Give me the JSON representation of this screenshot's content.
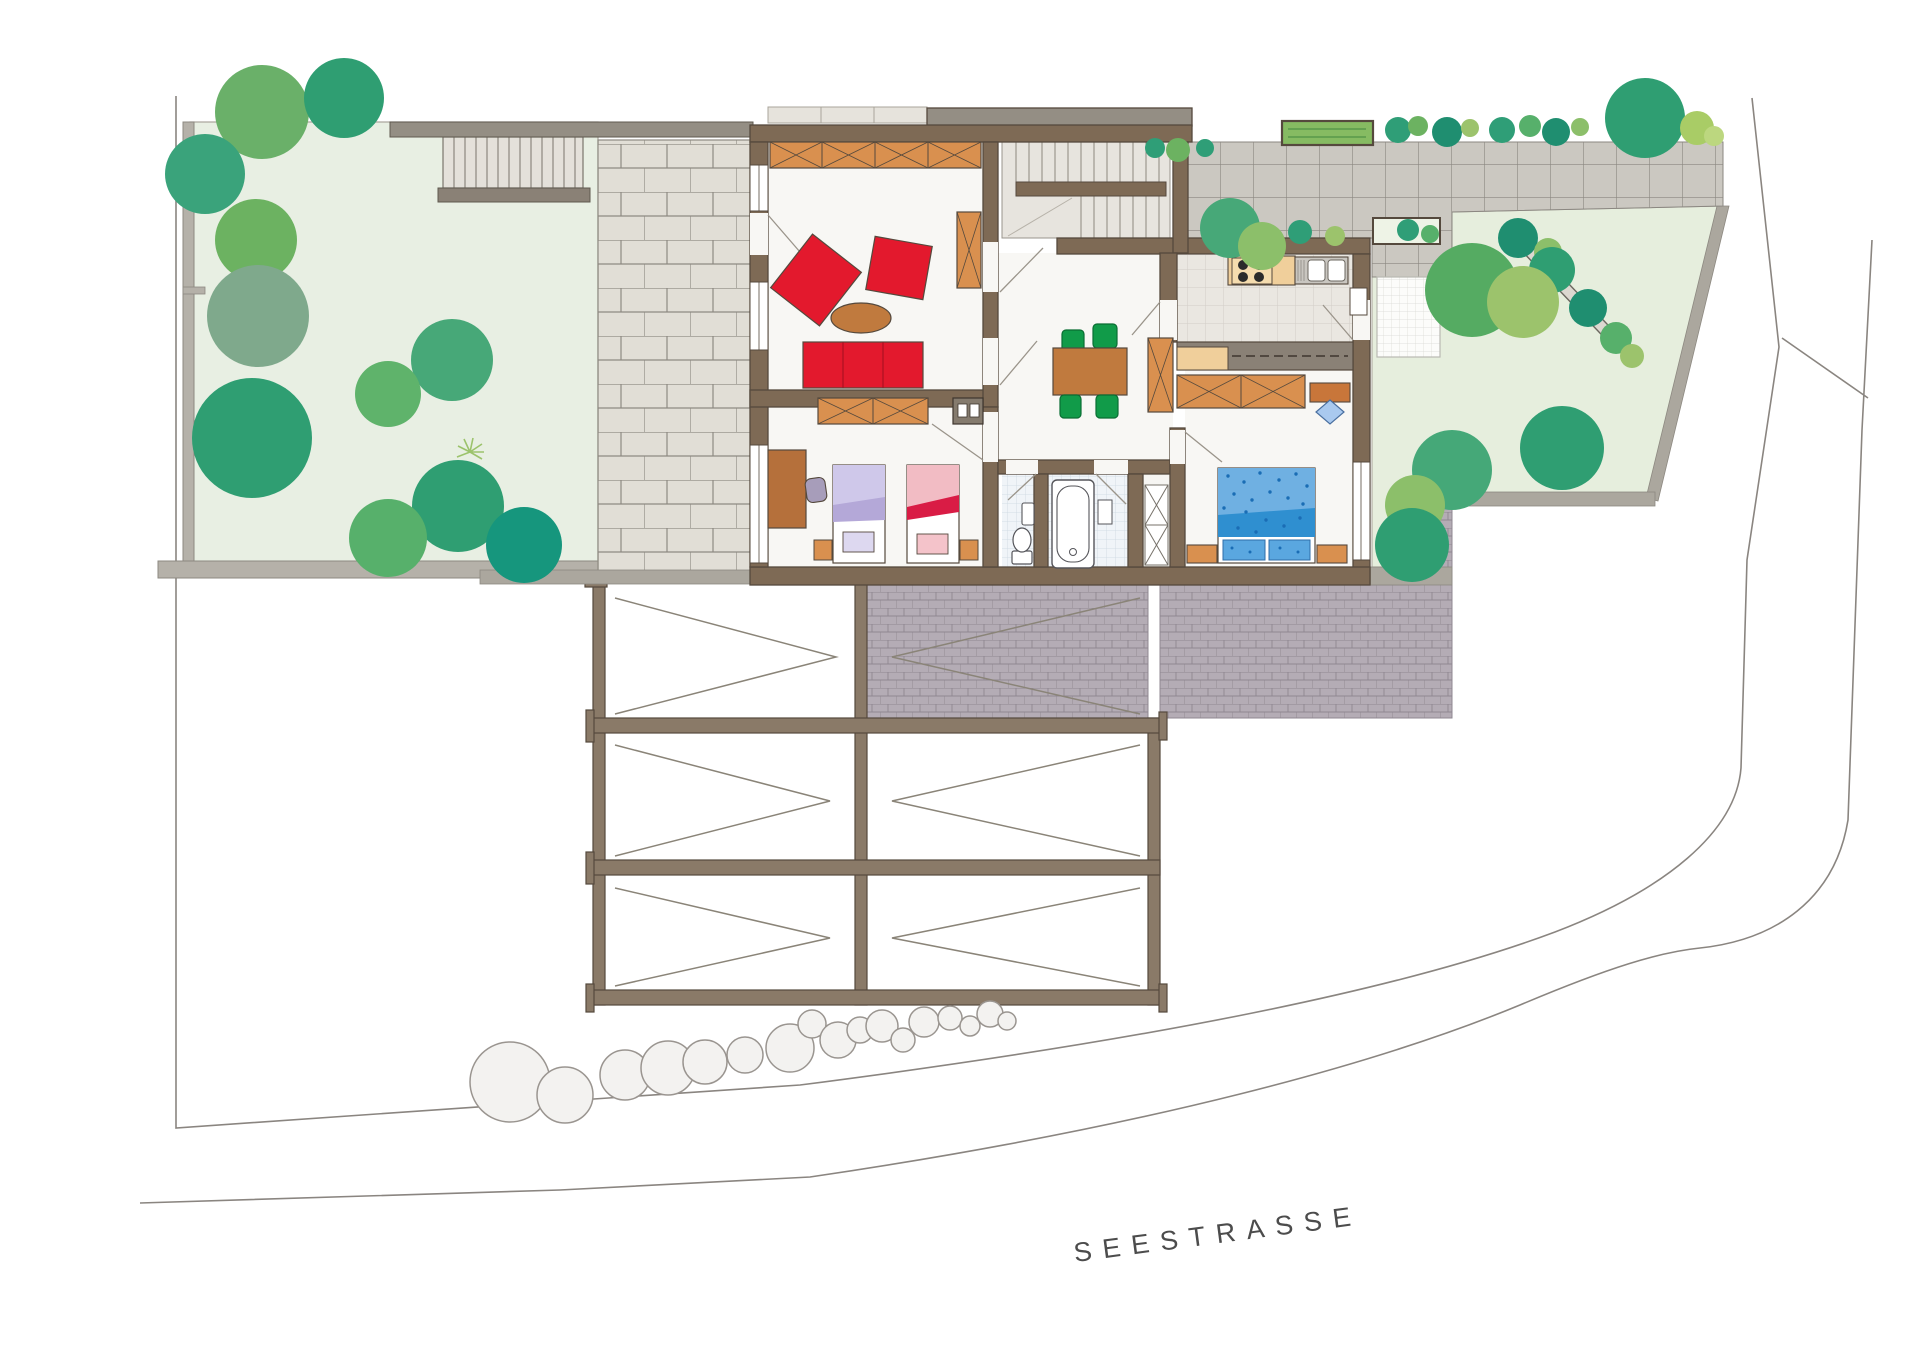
{
  "plan": {
    "street_label": "SEESTRASSE",
    "palette": {
      "lawn": "#e8efe3",
      "lawn_edge": "#a9a49b",
      "wall_brown": "#7e6a55",
      "wall_gray": "#948e84",
      "site_band": "#aba79e",
      "brick_paver": "#e1ded6",
      "driveway": "#cbc8c1",
      "garage_roof": "#b4acb5",
      "furniture_orange": "#d9904f",
      "counter_beige": "#f0cf9b",
      "accent_red": "#e3192d",
      "chair_green": "#119b49",
      "table_brown": "#c07a3e",
      "bed_lilac": "#cfc8ea",
      "bed_pink": "#f2bcc4",
      "bed_blue": "#6fb0e2",
      "bed_blue_dark": "#2f8fd0",
      "chair_blue": "#a9c9ef",
      "bath_tile": "#f0f4f8",
      "tree_dark": "#2f9e72",
      "tree_mid": "#47a878",
      "tree_light": "#8cbf6a",
      "tree_gray": "#7fa98c",
      "shrub_teal": "#1f8e70",
      "outline": "#55493d",
      "street_line": "#8a8580",
      "label_color": "#4c4c4c"
    }
  }
}
